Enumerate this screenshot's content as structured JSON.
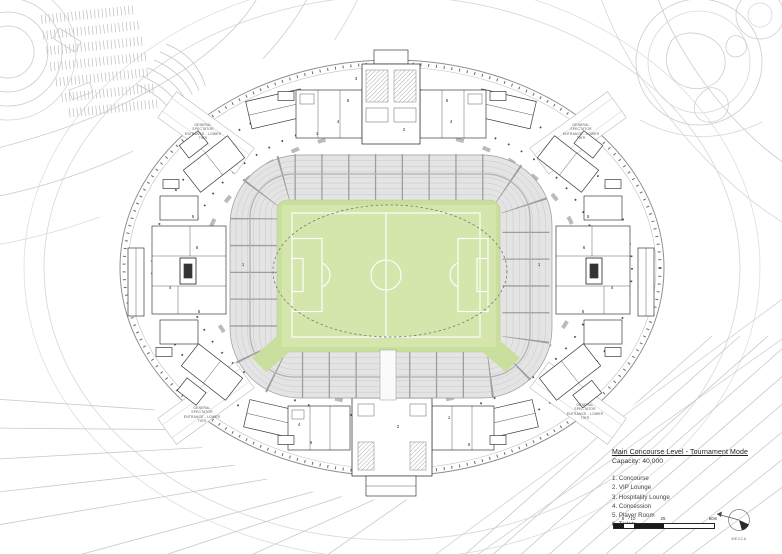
{
  "legend": {
    "title": "Main Concourse Level - Tournament Mode",
    "capacity": "Capacity: 40,000",
    "items": [
      "1. Concourse",
      "2. VIP Lounge",
      "3. Hospitality Lounge",
      "4. Concession",
      "5. Player Room",
      "6. Toilets"
    ]
  },
  "scale_bar": {
    "ticks": [
      "5",
      "10",
      "25",
      "50m"
    ]
  },
  "compass": {
    "label": "MECCA"
  },
  "entrance_label": {
    "text": "GENERAL\nSPECTATOR\nENTRANCE - LOWER\nTIER"
  },
  "plan": {
    "room_labels": [
      "6",
      "4",
      "1",
      "3",
      "2",
      "6",
      "4",
      "5",
      "6",
      "4",
      "1",
      "6",
      "5",
      "6",
      "4",
      "1",
      "6",
      "2",
      "1",
      "4",
      "6",
      "6"
    ]
  },
  "colors": {
    "pitch_green": "#c9df9e",
    "pitch_green_light": "#d5e6ad",
    "seating_gray": "#e4e4e4",
    "plan_line_dark": "#3a3a3a",
    "site_line": "#cccccc"
  }
}
